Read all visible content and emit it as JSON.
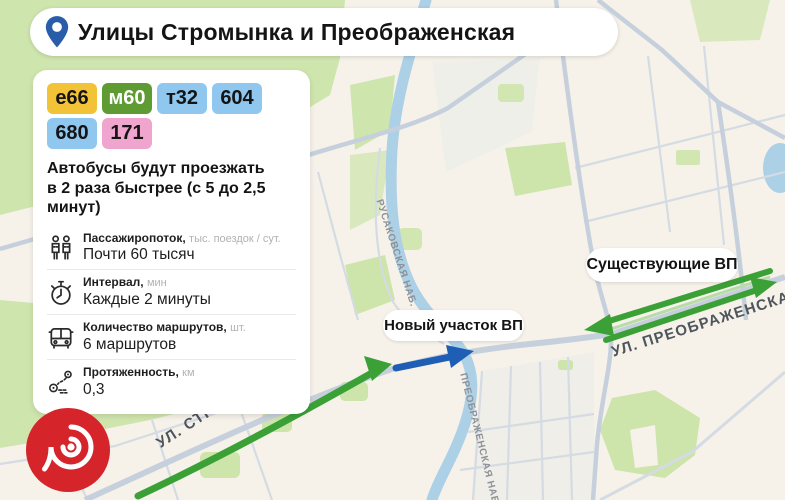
{
  "header": {
    "title": "Улицы Стромынка и Преображенская"
  },
  "routes": [
    {
      "label": "е66",
      "bg": "#F2C337",
      "fg": "#141414"
    },
    {
      "label": "м60",
      "bg": "#5E9C33",
      "fg": "#FFFFFF"
    },
    {
      "label": "т32",
      "bg": "#8FC7EF",
      "fg": "#141414"
    },
    {
      "label": "604",
      "bg": "#8FC7EF",
      "fg": "#141414"
    },
    {
      "label": "680",
      "bg": "#8FC7EF",
      "fg": "#141414"
    },
    {
      "label": "171",
      "bg": "#EFA5CE",
      "fg": "#141414"
    }
  ],
  "card": {
    "headline_line1": "Автобусы будут проезжать",
    "headline_line2": "в 2 раза быстрее (с 5 до 2,5 минут)"
  },
  "stats": [
    {
      "icon": "passengers-icon",
      "label": "Пассажиропоток,",
      "unit": "тыс. поездок / сут.",
      "value": "Почти 60 тысяч"
    },
    {
      "icon": "stopwatch-icon",
      "label": "Интервал,",
      "unit": "мин",
      "value": "Каждые 2 минуты"
    },
    {
      "icon": "bus-icon",
      "label": "Количество маршрутов,",
      "unit": "шт.",
      "value": "6 маршрутов"
    },
    {
      "icon": "route-icon",
      "label": "Протяженность,",
      "unit": "км",
      "value": "0,3"
    }
  ],
  "map": {
    "pill_new": "Новый участок ВП",
    "pill_existing": "Существующие ВП",
    "street_stromynka": "УЛ. СТРОМЫНКА",
    "street_preobrazhenskaya": "УЛ. ПРЕОБРАЖЕНСКАЯ",
    "street_rusakovskaya_nab": "РУСАКОВСКАЯ НАБ.",
    "street_preobrazhenskaya_nab": "ПРЕОБРАЖЕНСКАЯ НАБ."
  },
  "colors": {
    "existing_lane_green": "#3BA136",
    "new_lane_blue": "#1E5EB5",
    "pin_blue": "#2A5DA9",
    "logo_red": "#D6242B",
    "map_base": "#F6F2EA",
    "park_green": "#CFE5AE",
    "river_blue": "#ACD0E6",
    "road_gray": "#C6D0DC"
  }
}
